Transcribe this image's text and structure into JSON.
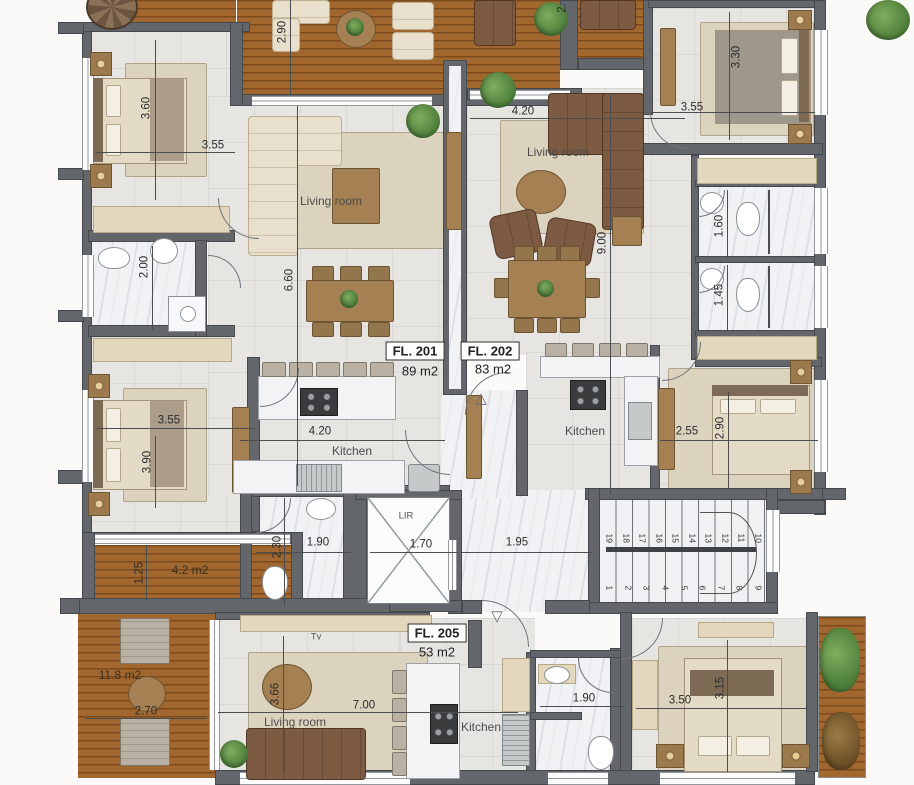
{
  "units": [
    {
      "label": "FL. 201",
      "area": "89 m2"
    },
    {
      "label": "FL. 202",
      "area": "83 m2"
    },
    {
      "label": "FL. 205",
      "area": "53 m2"
    }
  ],
  "rooms": {
    "living": "Living room",
    "kitchen": "Kitchen",
    "tv": "Tv",
    "lift": "LIR"
  },
  "balconies": {
    "small": "4.2 m2",
    "large": "11.8 m2"
  },
  "dims": {
    "balcony_top": "2.90",
    "bedroom1_w": "3.60",
    "bedroom1_l": "3.55",
    "living202_w": "4.20",
    "bedroom3_l": "3.55",
    "bedroom3_w": "3.30",
    "bath201": "2.00",
    "living201_h": "6.60",
    "living202_h": "9.00",
    "bath_a": "1.60",
    "bath_b": "1.45",
    "bedroom2_l": "3.55",
    "bedroom2_w": "3.90",
    "kitchen201_w": "4.20",
    "bedroom4_l": "2.55",
    "bedroom4_w": "2.90",
    "wc205": "2.30",
    "hall_left": "1.90",
    "lift_w": "1.70",
    "hall_right": "1.95",
    "balcony_small_w": "1.25",
    "balcony_large_w": "2.70",
    "living205_h": "3.66",
    "living205_w": "7.00",
    "bath205": "1.90",
    "bedroom5_l": "3.50",
    "bedroom5_w": "3.15",
    "top_edge_partial": "2."
  },
  "stairs": {
    "flight_lower": [
      "1",
      "2",
      "3",
      "4",
      "5",
      "6",
      "7",
      "8",
      "9"
    ],
    "flight_upper": [
      "19",
      "18",
      "17",
      "16",
      "15",
      "14",
      "13",
      "12",
      "11",
      "10"
    ]
  },
  "colors": {
    "wall": "#63666a",
    "wood": "#a2672e",
    "tile": "#e7e5e1",
    "marble": "#f1f2f4",
    "rug": "#dcd3bf",
    "sofa_brown": "#7d5a42",
    "sofa_cream": "#e8e0cd",
    "plant": "#4c7d39",
    "text": "#2c2c2c"
  }
}
